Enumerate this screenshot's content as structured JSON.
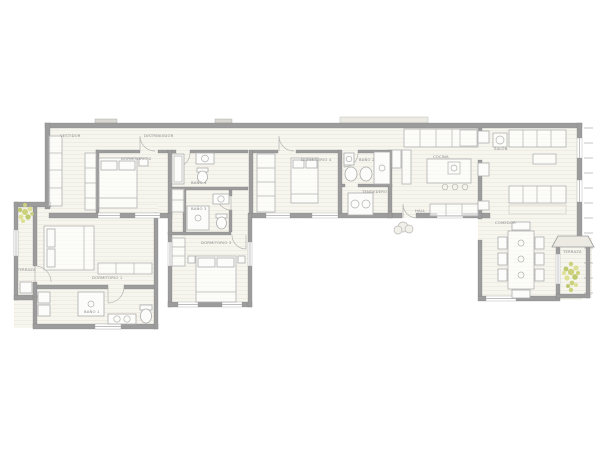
{
  "page": {
    "type": "architectural-floor-plan"
  },
  "colors": {
    "background": "#ffffff",
    "floor": "#f6f5ee",
    "floor_line": "#e4e1d4",
    "wall": "#9c9c9c",
    "furniture_line": "#b2b2b2",
    "label_text": "#8a8a8a",
    "plant": "#ccd17c",
    "awning": "#eceae3"
  },
  "decorations": [
    "plant-terraza-comedor",
    "plant-terraza-dormitorio",
    "bush-entrance"
  ],
  "rooms": [
    {
      "id": "vestidor",
      "label": "VESTIDOR"
    },
    {
      "id": "distribuidor",
      "label": "DISTRIBUIDOR"
    },
    {
      "id": "dormitorio-2",
      "label": "DORMITORIO 2"
    },
    {
      "id": "bano-4",
      "label": "BAÑO 4"
    },
    {
      "id": "bano-3",
      "label": "BAÑO 3"
    },
    {
      "id": "dormitorio-3",
      "label": "DORMITORIO 3"
    },
    {
      "id": "dormitorio-4",
      "label": "DORMITORIO 4"
    },
    {
      "id": "bano-2",
      "label": "BAÑO 2"
    },
    {
      "id": "tendedero",
      "label": "TENDEDERO"
    },
    {
      "id": "hall",
      "label": "HALL"
    },
    {
      "id": "cocina",
      "label": "COCINA"
    },
    {
      "id": "salon",
      "label": "SALÓN"
    },
    {
      "id": "comedor",
      "label": "COMEDOR"
    },
    {
      "id": "terraza-comedor",
      "label": "TERRAZA"
    },
    {
      "id": "terraza-dormitorio1",
      "label": "TERRAZA"
    },
    {
      "id": "dormitorio-1",
      "label": "DORMITORIO 1"
    },
    {
      "id": "bano-1",
      "label": "BAÑO 1"
    }
  ]
}
